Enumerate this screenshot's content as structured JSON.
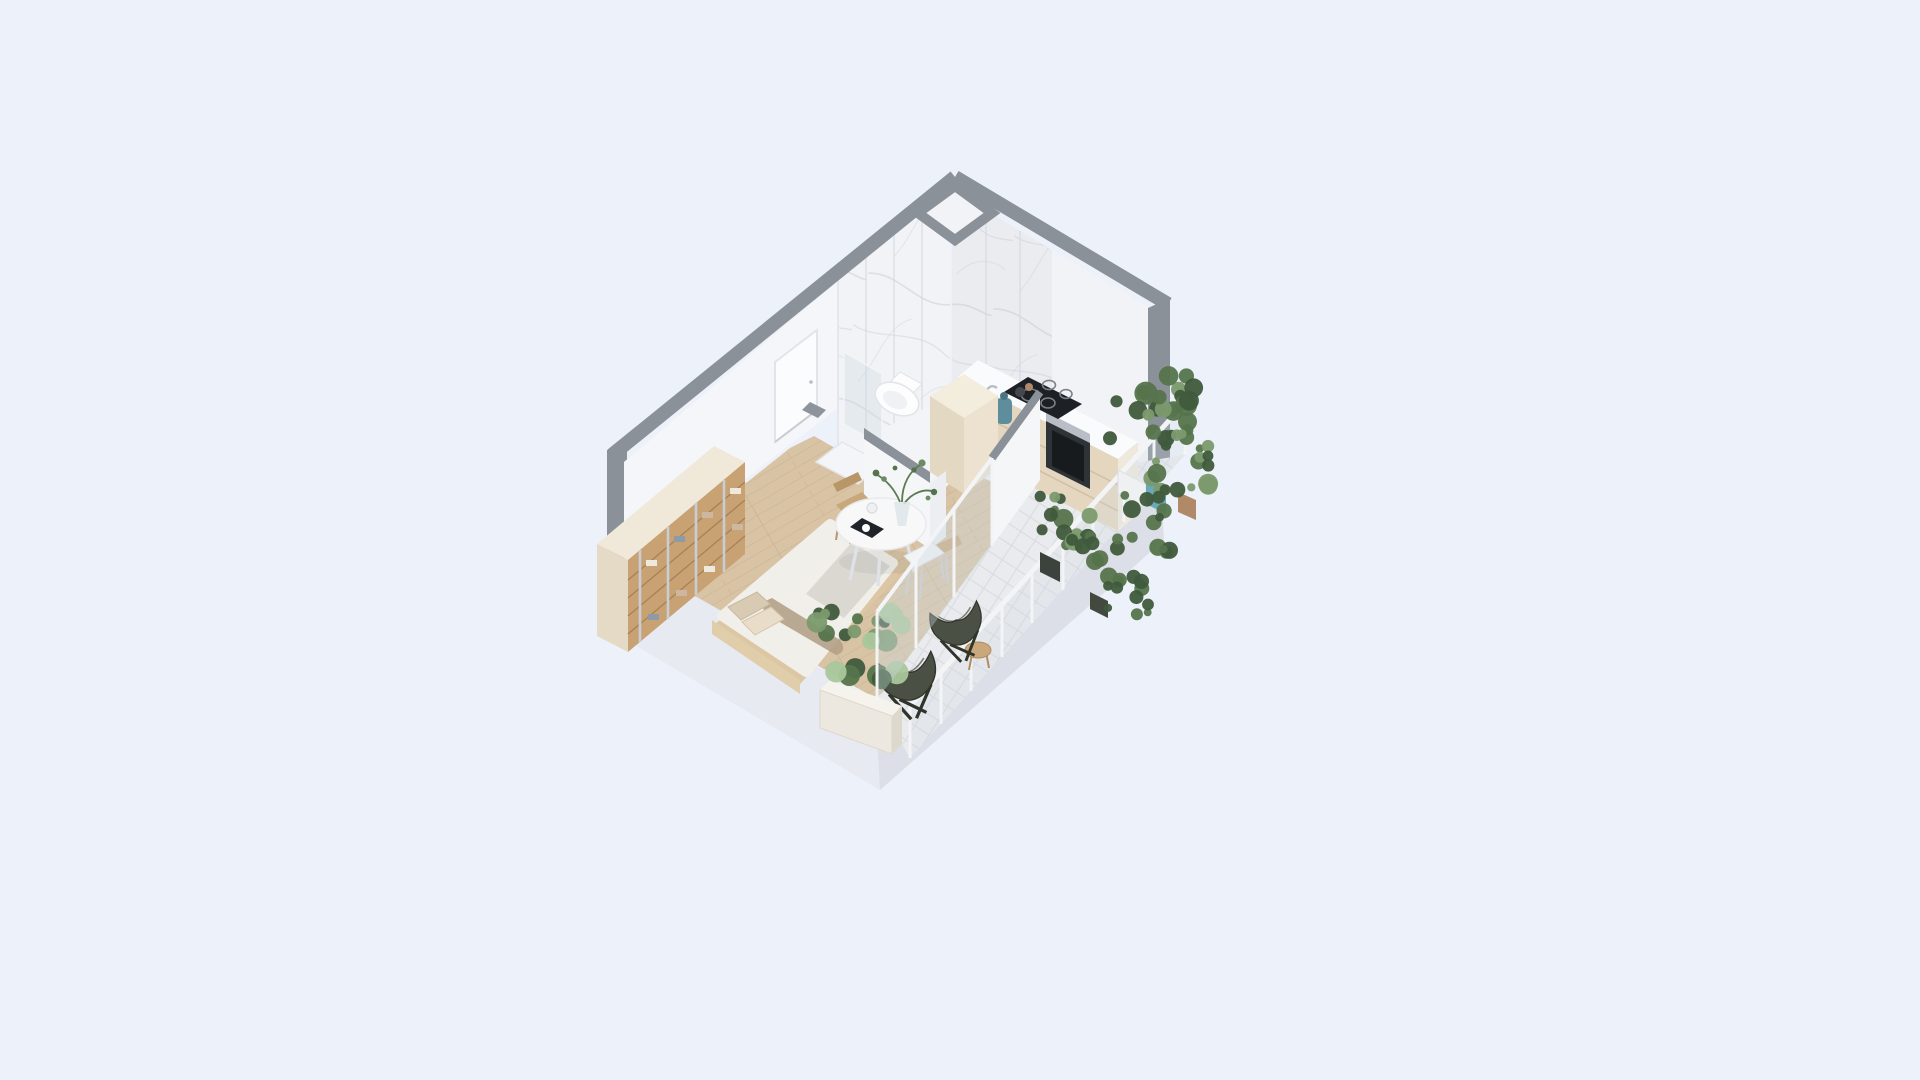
{
  "meta": {
    "kind": "isometric-studio-apartment-3d-render",
    "background": "#edf1f9",
    "no_visible_text": true
  },
  "palette": {
    "background": "#edf1f9",
    "wall_cap": "#8b9199",
    "wall_cap_soft": "#9aa0a8",
    "wall_white": "#fbfcfe",
    "wall_shade": "#eef0f5",
    "marble_base": "#f2f3f6",
    "marble_vein": "#d5d9e0",
    "slab_light": "#e7eaf1",
    "slab_mid": "#dcdfe8",
    "floor_wood": "#d9c3a5",
    "floor_wood_line": "#c3aa87",
    "bath_floor": "#f3f4f7",
    "tile_balcony": "#e9ebee",
    "tile_line": "#d6d9de",
    "cabinet_beige": "#e4d6bf",
    "cabinet_line": "#d0c0a6",
    "counter_white": "#fafbfc",
    "cooktop_black": "#1d2024",
    "ring_gray": "#7c828a",
    "oven_dark": "#2e3338",
    "oven_glass": "#16181c",
    "steel": "#b9bec6",
    "carafe_teal": "#5e8e9c",
    "column_top": "#f3edde",
    "column_left": "#e3d8c2",
    "column_right": "#ece2cf",
    "island_white": "#f5f6f8",
    "wardrobe_top": "#f0e9da",
    "wardrobe_side": "#e4dac6",
    "wardrobe_wood": "#c8a272",
    "wardrobe_shelf": "#a37d52",
    "chrome": "#c9cdd5",
    "cloth_light": "#efe9dd",
    "cloth_tan": "#cdb7a0",
    "cloth_blue": "#8e9aa6",
    "bed_frame": "#dcc6a3",
    "bed_headboard": "#e0cdaa",
    "bed_duvet": "#f1efe9",
    "bed_blanket": "#d9d6d1",
    "bed_throw": "#b3a188",
    "bed_pillow_a": "#d9cab4",
    "bed_pillow_b": "#e9ddc9",
    "table_white": "#f8f8f9",
    "table_leg": "#dfe1e6",
    "chair_wood": "#c8a77b",
    "chair_wood_dark": "#b99668",
    "chair_white": "#f2f3f5",
    "chair_leg_steel": "#c9ccd2",
    "tablet_dark": "#20242a",
    "cup_white": "#eef0f2",
    "vase_glass": "#dde6ea",
    "stem_green": "#5b7a52",
    "leaf_a": "#54724d",
    "leaf_b": "#6d8b63",
    "toilet_white": "#fdfdfe",
    "toilet_line": "#e2e4e9",
    "glass_blue": "#cdd9e3",
    "glass_frame": "#f2f4f6",
    "door_white": "#fbfcfd",
    "door_frame": "#e2e4e9",
    "fixture_gray": "#8e949c",
    "tray_white": "#f4f5f8",
    "olive_chair": "#4a5044",
    "olive_dark": "#30352b",
    "stool_wood": "#c9a87c",
    "stool_leg": "#b08c5e",
    "pot_dark": "#3c423c",
    "pot_dark2": "#43493f",
    "pot_teal": "#6ba8b8",
    "pot_terracotta": "#b08968",
    "pot_white": "#eef0f2",
    "planter_front": "#ece8df",
    "planter_top": "#f6f3ec",
    "planter_side": "#ddd8cc",
    "green_dark": "#3f5a3c",
    "green_mid": "#55744c",
    "green_light": "#7b9a6d",
    "green_pale": "#a9c79b"
  },
  "scene": {
    "rooms": [
      "bathroom",
      "kitchen",
      "living-sleeping-area",
      "balcony"
    ],
    "fixtures": [
      "wall-hung-toilet",
      "glass-shower",
      "induction-cooktop-4-rings",
      "built-in-oven",
      "kitchen-sink",
      "tall-cabinet-column",
      "island-half-wall",
      "entry-door",
      "corner-shaft-notch"
    ],
    "furniture": [
      "open-wardrobe-with-clothes",
      "double-bed",
      "round-dining-table",
      "wood-chair",
      "white-chair",
      "butterfly-chair-1",
      "butterfly-chair-2",
      "wood-stool",
      "teal-carafe",
      "tablet-on-table",
      "glass-cup",
      "vase-with-branches"
    ],
    "balcony_items": [
      "glass-partition",
      "white-railing-with-posts",
      "tile-floor-diamond-grid",
      "planter-boxes",
      "potted-plants"
    ]
  },
  "plants": [
    {
      "name": "corner-tall-plant",
      "cx": 1152,
      "cy": 408,
      "sx": 42,
      "sy": 36,
      "count": 24,
      "rmin": 5,
      "rmax": 12,
      "colors": [
        "green_dark",
        "green_mid",
        "green_light"
      ]
    },
    {
      "name": "corner-mid-plant",
      "cx": 1182,
      "cy": 462,
      "sx": 34,
      "sy": 30,
      "count": 16,
      "rmin": 4,
      "rmax": 10,
      "colors": [
        "green_mid",
        "green_dark",
        "green_light"
      ]
    },
    {
      "name": "corner-trailing",
      "cx": 1150,
      "cy": 522,
      "sx": 30,
      "sy": 34,
      "count": 14,
      "rmin": 4,
      "rmax": 9,
      "colors": [
        "green_mid",
        "green_dark"
      ]
    },
    {
      "name": "rail-bush-1",
      "cx": 1060,
      "cy": 520,
      "sx": 30,
      "sy": 28,
      "count": 15,
      "rmin": 4,
      "rmax": 10,
      "colors": [
        "green_mid",
        "green_dark",
        "green_light"
      ]
    },
    {
      "name": "rail-bush-2",
      "cx": 1098,
      "cy": 562,
      "sx": 26,
      "sy": 30,
      "count": 12,
      "rmin": 4,
      "rmax": 9,
      "colors": [
        "green_dark",
        "green_mid"
      ]
    },
    {
      "name": "rail-low-trail",
      "cx": 1128,
      "cy": 602,
      "sx": 22,
      "sy": 26,
      "count": 10,
      "rmin": 3,
      "rmax": 8,
      "colors": [
        "green_mid",
        "green_dark"
      ]
    },
    {
      "name": "south-planter-plant",
      "cx": 858,
      "cy": 646,
      "sx": 44,
      "sy": 36,
      "count": 22,
      "rmin": 5,
      "rmax": 12,
      "colors": [
        "green_mid",
        "green_pale",
        "green_dark",
        "green_light"
      ]
    }
  ]
}
